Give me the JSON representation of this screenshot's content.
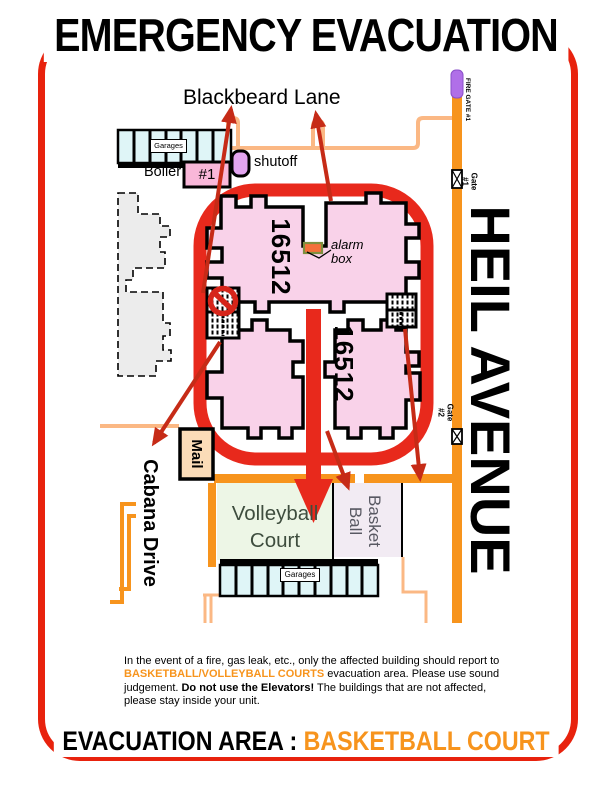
{
  "title": "EMERGENCY EVACUATION",
  "banner": {
    "label": "EVACUATION AREA : ",
    "area": "BASKETBALL COURT"
  },
  "streets": {
    "top": "Blackbeard Lane",
    "right": "HEIL AVENUE",
    "left": "Cabana Drive"
  },
  "buildings": {
    "upper_number": "16512",
    "lower_number": "16512"
  },
  "map_labels": {
    "garages_top": "Garages",
    "garages_bottom": "Garages",
    "boiler": "Boiler",
    "boiler_number": "#1",
    "shutoff": "shutoff",
    "alarm_line1": "alarm",
    "alarm_line2": "box",
    "mail": "Mail"
  },
  "gates": {
    "fire_gate": "FIRE GATE #1",
    "gate1_name": "Gate",
    "gate1_number": "#1",
    "gate2_name": "Gate",
    "gate2_number": "#2"
  },
  "courts": {
    "volleyball_line1": "Volleyball",
    "volleyball_line2": "Court",
    "basketball_line1": "Basket",
    "basketball_line2": "Ball"
  },
  "notice": {
    "part1": "In the event of a fire, gas leak, etc., only the affected building should report to ",
    "highlight": "BASKETBALL/VOLLEYBALL COURTS",
    "part2": " evacuation area. Please use sound judgement. ",
    "emphasis": "Do not use the Elevators!",
    "part3": " The buildings that are not affected, please stay inside your unit."
  },
  "colors": {
    "border_red": "#E8220D",
    "route_red": "#E8291C",
    "arrow_red": "#C62B17",
    "road_orange": "#F7941D",
    "road_peach": "#FBB884",
    "building_pink": "#F9D2E9",
    "court_green": "#EDF6E6",
    "court_lavender": "#F2EBF3",
    "garage_cyan": "#DFF5F7",
    "gate_purple": "#B06FE8",
    "highlight_orange": "#F7941D"
  }
}
